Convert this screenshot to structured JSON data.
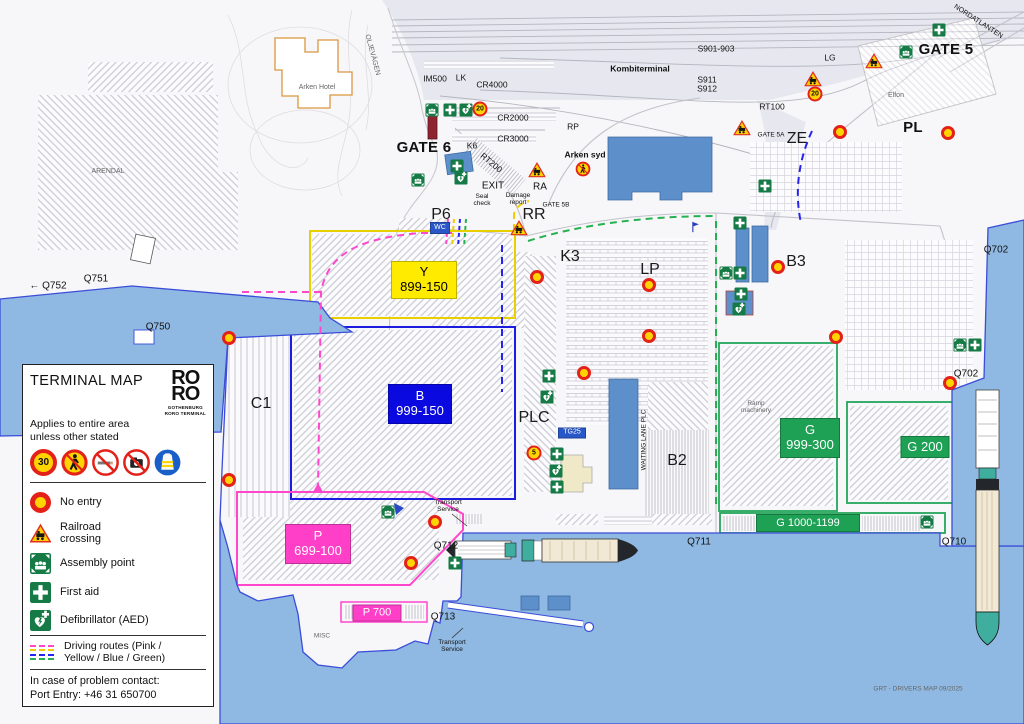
{
  "legend": {
    "title": "TERMINAL MAP",
    "logo_line1": "RO",
    "logo_line2": "RO",
    "logo_caption": "GOTHENBURG\nRORO TERMINAL",
    "subtitle": "Applies to entire area\nunless other stated",
    "speed_sign": "30",
    "signs": [
      "speed-30",
      "no-pedestrians",
      "no-smoking",
      "no-photography",
      "hi-vis-vest-mandatory"
    ],
    "items": [
      {
        "icon": "ne",
        "label": "No entry"
      },
      {
        "icon": "rl",
        "label": "Railroad\ncrossing"
      },
      {
        "icon": "as",
        "label": "Assembly point"
      },
      {
        "icon": "fa",
        "label": "First aid"
      },
      {
        "icon": "de",
        "label": "Defibrillator (AED)"
      }
    ],
    "routes_label": "Driving routes (Pink /\nYellow / Blue / Green)",
    "route_colors": [
      "#ff47cc",
      "#f0cc00",
      "#2525f0",
      "#25b14f"
    ],
    "contact_line1": "In case of problem contact:",
    "contact_line2": "Port Entry: +46 31 650700"
  },
  "map": {
    "zone_colors": {
      "yellow": "#e8cf00",
      "blue": "#1c1cdf",
      "pink": "#ff47cc",
      "green": "#23a65a"
    },
    "water_color": "#8fb9e2",
    "labels": [
      {
        "t": "Kombiterminal",
        "x": 640,
        "y": 69,
        "c": "sm b",
        "n": "label-kombiterminal"
      },
      {
        "t": "S901-903",
        "x": 716,
        "y": 49,
        "c": "sm"
      },
      {
        "t": "S911",
        "x": 707,
        "y": 80,
        "c": "sm"
      },
      {
        "t": "S912",
        "x": 707,
        "y": 89,
        "c": "sm"
      },
      {
        "t": "IM500",
        "x": 435,
        "y": 79,
        "c": "sm"
      },
      {
        "t": "LK",
        "x": 461,
        "y": 78,
        "c": "sm"
      },
      {
        "t": "CR4000",
        "x": 492,
        "y": 85,
        "c": "sm"
      },
      {
        "t": "CR2000",
        "x": 513,
        "y": 118,
        "c": "sm"
      },
      {
        "t": "CR3000",
        "x": 513,
        "y": 139,
        "c": "sm"
      },
      {
        "t": "RP",
        "x": 573,
        "y": 127,
        "c": "sm"
      },
      {
        "t": "LG",
        "x": 830,
        "y": 58,
        "c": "sm"
      },
      {
        "t": "RT100",
        "x": 772,
        "y": 107,
        "c": "sm"
      },
      {
        "t": "GATE 5",
        "x": 946,
        "y": 50,
        "c": "xl",
        "n": "label-gate-5"
      },
      {
        "t": "GATE 6",
        "x": 424,
        "y": 148,
        "c": "xl",
        "n": "label-gate-6"
      },
      {
        "t": "PL",
        "x": 913,
        "y": 128,
        "c": "xl"
      },
      {
        "t": "ZE",
        "x": 797,
        "y": 139,
        "c": "lg"
      },
      {
        "t": "NORDATLANTEN",
        "x": 978,
        "y": 22,
        "c": "xs",
        "r": 33
      },
      {
        "t": "OLJEVÄGEN",
        "x": 372,
        "y": 55,
        "c": "xs g",
        "r": 75
      },
      {
        "t": "ARENDAL",
        "x": 108,
        "y": 172,
        "c": "xs g"
      },
      {
        "t": "Arken Hotel",
        "x": 317,
        "y": 88,
        "c": "xs g"
      },
      {
        "t": "Elfon",
        "x": 896,
        "y": 96,
        "c": "xs g"
      },
      {
        "t": "GATE 5A",
        "x": 771,
        "y": 135,
        "c": "xxs"
      },
      {
        "t": "K6",
        "x": 472,
        "y": 146,
        "c": "sm"
      },
      {
        "t": "RT200",
        "x": 491,
        "y": 163,
        "c": "sm",
        "r": 40
      },
      {
        "t": "Arken syd",
        "x": 585,
        "y": 155,
        "c": "sm b"
      },
      {
        "t": "EXIT",
        "x": 493,
        "y": 186,
        "c": "md"
      },
      {
        "t": "RA",
        "x": 540,
        "y": 187,
        "c": "md"
      },
      {
        "t": "Seal\ncheck",
        "x": 482,
        "y": 200,
        "c": "xxs ml"
      },
      {
        "t": "Damage\nreport",
        "x": 518,
        "y": 199,
        "c": "xxs ml"
      },
      {
        "t": "GATE 5B",
        "x": 556,
        "y": 205,
        "c": "xxs"
      },
      {
        "t": "P6",
        "x": 441,
        "y": 215,
        "c": "lg"
      },
      {
        "t": "RR",
        "x": 534,
        "y": 215,
        "c": "lg"
      },
      {
        "t": "K3",
        "x": 570,
        "y": 257,
        "c": "lg"
      },
      {
        "t": "LP",
        "x": 650,
        "y": 270,
        "c": "lg"
      },
      {
        "t": "B3",
        "x": 796,
        "y": 262,
        "c": "lg"
      },
      {
        "t": "C1",
        "x": 261,
        "y": 404,
        "c": "lg"
      },
      {
        "t": "PLC",
        "x": 534,
        "y": 418,
        "c": "lg"
      },
      {
        "t": "B2",
        "x": 677,
        "y": 461,
        "c": "lg"
      },
      {
        "t": "Q702",
        "x": 996,
        "y": 250,
        "c": "md"
      },
      {
        "t": "Q702",
        "x": 966,
        "y": 374,
        "c": "md"
      },
      {
        "t": "Q751",
        "x": 96,
        "y": 279,
        "c": "md"
      },
      {
        "t": "← Q752",
        "x": 48,
        "y": 286,
        "c": "md"
      },
      {
        "t": "Q750",
        "x": 158,
        "y": 327,
        "c": "md"
      },
      {
        "t": "Q712",
        "x": 446,
        "y": 546,
        "c": "md"
      },
      {
        "t": "Q711",
        "x": 699,
        "y": 542,
        "c": "md"
      },
      {
        "t": "Q710",
        "x": 954,
        "y": 542,
        "c": "md"
      },
      {
        "t": "Q713",
        "x": 443,
        "y": 617,
        "c": "md"
      },
      {
        "t": "MISC",
        "x": 322,
        "y": 636,
        "c": "xxs g"
      },
      {
        "t": "Transport\nService",
        "x": 448,
        "y": 506,
        "c": "xxs ml"
      },
      {
        "t": "Transport\nService",
        "x": 452,
        "y": 646,
        "c": "xxs ml"
      },
      {
        "t": "Ramp\nmachinery",
        "x": 756,
        "y": 407,
        "c": "xxs ml g"
      },
      {
        "t": "WAITING LANE PLC",
        "x": 644,
        "y": 440,
        "c": "xxs",
        "r": -90
      },
      {
        "t": "GRT - DRIVERS MAP 09/2025",
        "x": 918,
        "y": 689,
        "c": "xxs g",
        "n": "map-credit"
      }
    ],
    "badges": [
      {
        "t": "Y\n899-150",
        "x": 424,
        "y": 280,
        "w": 64,
        "h": 36,
        "bg": "#ffeb00",
        "fg": "#000",
        "fs": 13,
        "n": "zone-badge-y"
      },
      {
        "t": "B\n999-150",
        "x": 420,
        "y": 404,
        "w": 62,
        "h": 38,
        "bg": "#0909e0",
        "fg": "#fff",
        "fs": 13,
        "n": "zone-badge-b"
      },
      {
        "t": "P\n699-100",
        "x": 318,
        "y": 544,
        "w": 64,
        "h": 38,
        "bg": "#ff3fc8",
        "fg": "#fff",
        "fs": 13,
        "n": "zone-badge-p"
      },
      {
        "t": "G\n999-300",
        "x": 810,
        "y": 438,
        "w": 58,
        "h": 38,
        "bg": "#1ea055",
        "fg": "#fff",
        "fs": 13,
        "n": "zone-badge-g"
      },
      {
        "t": "G 200",
        "x": 925,
        "y": 447,
        "w": 47,
        "h": 20,
        "bg": "#1ea055",
        "fg": "#fff",
        "fs": 13,
        "n": "zone-badge-g200"
      },
      {
        "t": "G 1000-1199",
        "x": 808,
        "y": 523,
        "w": 102,
        "h": 16,
        "bg": "#1ea055",
        "fg": "#fff",
        "fs": 11,
        "n": "zone-badge-g1000"
      },
      {
        "t": "P 700",
        "x": 377,
        "y": 613,
        "w": 47,
        "h": 15,
        "bg": "#ff3fc8",
        "fg": "#fff",
        "fs": 11,
        "n": "zone-badge-p700"
      },
      {
        "t": "WC",
        "x": 440,
        "y": 228,
        "w": 18,
        "h": 10,
        "bg": "#2a57c8",
        "fg": "#fff",
        "fs": 7,
        "n": "wc-sign"
      },
      {
        "t": "TG25",
        "x": 572,
        "y": 433,
        "w": 26,
        "h": 9,
        "bg": "#2a57c8",
        "fg": "#fff",
        "fs": 7,
        "n": "tg25-sign"
      }
    ],
    "icons": [
      {
        "k": "ne",
        "x": 229,
        "y": 338
      },
      {
        "k": "ne",
        "x": 229,
        "y": 480
      },
      {
        "k": "ne",
        "x": 584,
        "y": 373
      },
      {
        "k": "ne",
        "x": 537,
        "y": 277
      },
      {
        "k": "ne",
        "x": 649,
        "y": 285
      },
      {
        "k": "ne",
        "x": 778,
        "y": 267
      },
      {
        "k": "ne",
        "x": 649,
        "y": 336
      },
      {
        "k": "ne",
        "x": 836,
        "y": 337
      },
      {
        "k": "ne",
        "x": 950,
        "y": 383
      },
      {
        "k": "ne",
        "x": 435,
        "y": 522
      },
      {
        "k": "ne",
        "x": 411,
        "y": 563
      },
      {
        "k": "ne",
        "x": 840,
        "y": 132
      },
      {
        "k": "ne",
        "x": 948,
        "y": 133
      },
      {
        "k": "sp",
        "t": "20",
        "x": 480,
        "y": 109
      },
      {
        "k": "sp",
        "t": "20",
        "x": 815,
        "y": 94
      },
      {
        "k": "sp",
        "t": "5",
        "x": 534,
        "y": 453
      },
      {
        "k": "np",
        "x": 583,
        "y": 169
      },
      {
        "k": "fa",
        "x": 450,
        "y": 110
      },
      {
        "k": "fa",
        "x": 457,
        "y": 166
      },
      {
        "k": "fa",
        "x": 939,
        "y": 30
      },
      {
        "k": "fa",
        "x": 740,
        "y": 223
      },
      {
        "k": "fa",
        "x": 765,
        "y": 186
      },
      {
        "k": "fa",
        "x": 740,
        "y": 273
      },
      {
        "k": "fa",
        "x": 741,
        "y": 294
      },
      {
        "k": "fa",
        "x": 549,
        "y": 376
      },
      {
        "k": "fa",
        "x": 975,
        "y": 345
      },
      {
        "k": "fa",
        "x": 455,
        "y": 563
      },
      {
        "k": "fa",
        "x": 557,
        "y": 487
      },
      {
        "k": "fa",
        "x": 557,
        "y": 454
      },
      {
        "k": "as",
        "x": 432,
        "y": 110
      },
      {
        "k": "as",
        "x": 418,
        "y": 180
      },
      {
        "k": "as",
        "x": 906,
        "y": 52
      },
      {
        "k": "as",
        "x": 726,
        "y": 273
      },
      {
        "k": "as",
        "x": 960,
        "y": 345
      },
      {
        "k": "as",
        "x": 927,
        "y": 522
      },
      {
        "k": "as",
        "x": 388,
        "y": 512
      },
      {
        "k": "de",
        "x": 466,
        "y": 110
      },
      {
        "k": "de",
        "x": 461,
        "y": 178
      },
      {
        "k": "de",
        "x": 739,
        "y": 309
      },
      {
        "k": "de",
        "x": 547,
        "y": 397
      },
      {
        "k": "de",
        "x": 556,
        "y": 471
      },
      {
        "k": "rl",
        "x": 874,
        "y": 61
      },
      {
        "k": "rl",
        "x": 813,
        "y": 79
      },
      {
        "k": "rl",
        "x": 742,
        "y": 128
      },
      {
        "k": "rl",
        "x": 537,
        "y": 170
      },
      {
        "k": "rl",
        "x": 519,
        "y": 228
      },
      {
        "k": "fl",
        "x": 695,
        "y": 227
      }
    ]
  }
}
